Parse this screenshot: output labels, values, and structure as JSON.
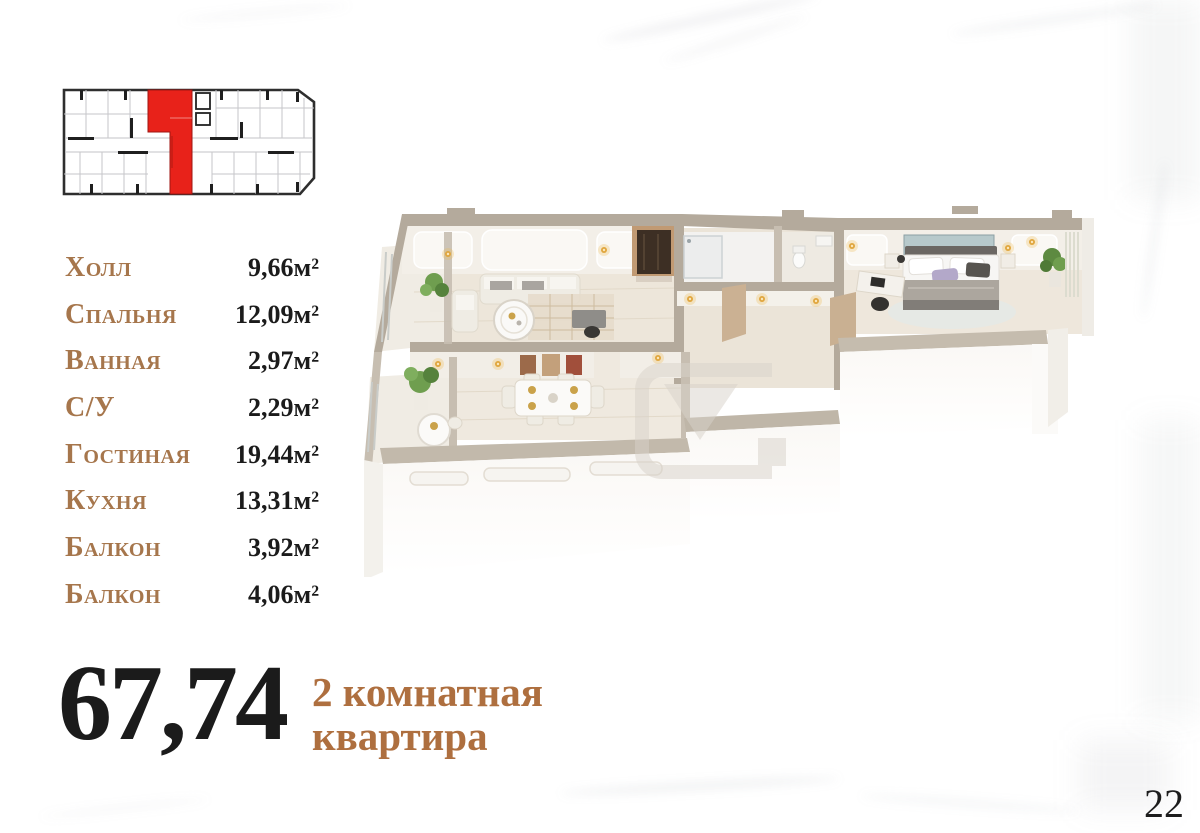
{
  "page": {
    "number": "22"
  },
  "apartment": {
    "total_area": "67,74",
    "type_line1": "2 комнатная",
    "type_line2": "квартира",
    "rooms": [
      {
        "name": "Холл",
        "area": "9,66м²"
      },
      {
        "name": "Спальня",
        "area": "12,09м²"
      },
      {
        "name": "Ванная",
        "area": "2,97м²"
      },
      {
        "name": "С/У",
        "area": "2,29м²"
      },
      {
        "name": "Гостиная",
        "area": "19,44м²"
      },
      {
        "name": "Кухня",
        "area": "13,31м²"
      },
      {
        "name": "Балкон",
        "area": "3,92м²"
      },
      {
        "name": "Балкон",
        "area": "4,06м²"
      }
    ]
  },
  "colors": {
    "accent_brown": "#a6764c",
    "title_brown": "#ae6f3f",
    "text_dark": "#1b1b1b",
    "highlight_red": "#e8221a",
    "lamp_gold": "#e0a63e",
    "wall_tan": "#b4aa9c",
    "floor_cream": "#ede6da"
  }
}
